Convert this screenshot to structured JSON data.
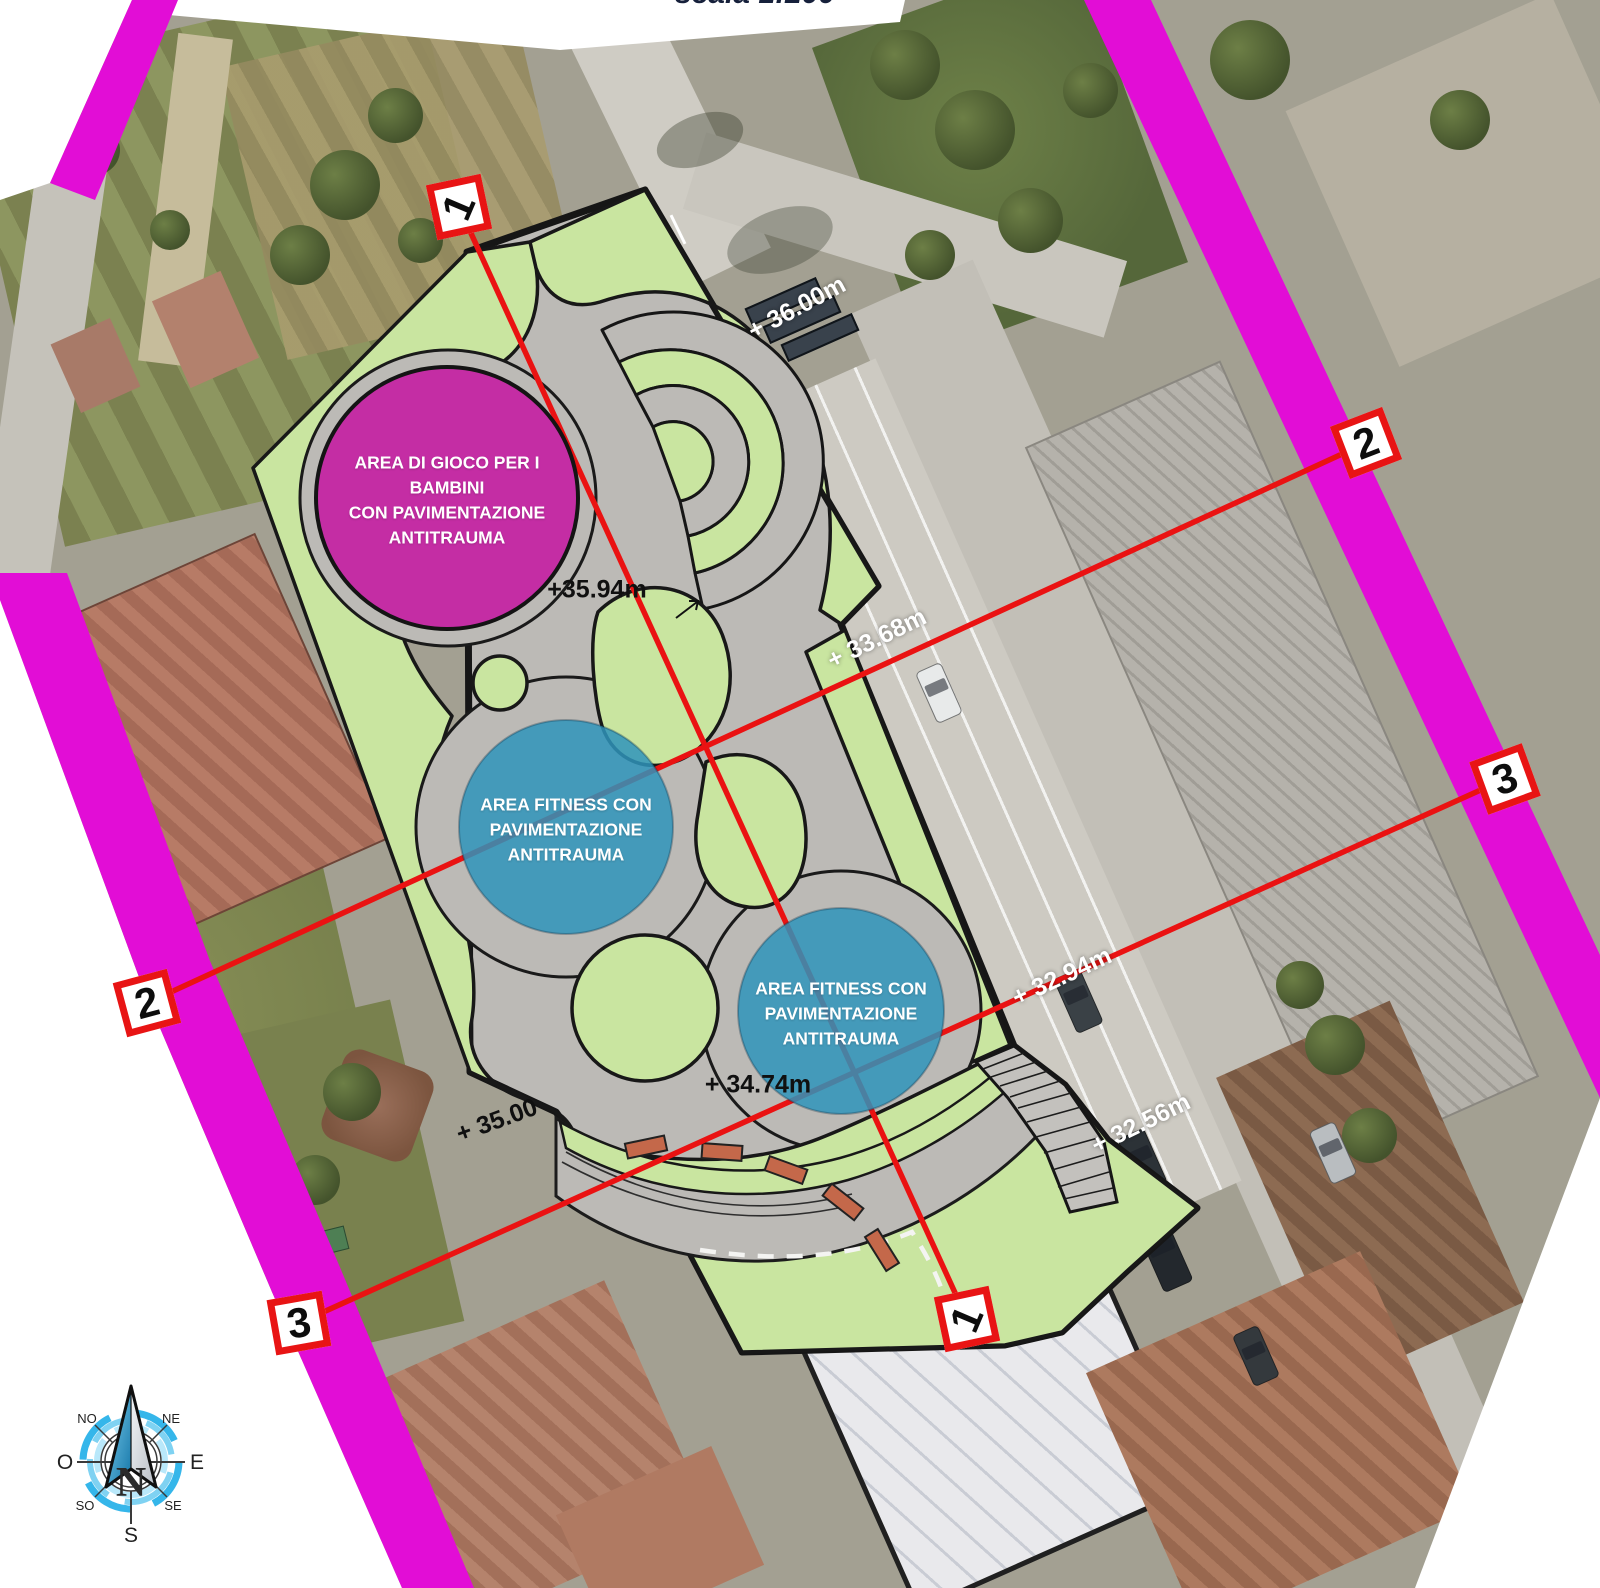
{
  "scale_label": "scala 1:200",
  "plan": {
    "play_area": {
      "lines": [
        "AREA DI GIOCO PER I BAMBINI",
        "CON PAVIMENTAZIONE",
        "ANTITRAUMA"
      ]
    },
    "fitness_area_1": {
      "lines": [
        "AREA FITNESS CON",
        "PAVIMENTAZIONE",
        "ANTITRAUMA"
      ]
    },
    "fitness_area_2": {
      "lines": [
        "AREA FITNESS CON",
        "PAVIMENTAZIONE",
        "ANTITRAUMA"
      ]
    }
  },
  "elevation_labels": [
    {
      "text": "+ 36.00m",
      "style": "white"
    },
    {
      "text": "+35.94m",
      "style": "black"
    },
    {
      "text": "+ 33.68m",
      "style": "white"
    },
    {
      "text": "+ 32.94m",
      "style": "white"
    },
    {
      "text": "+ 34.74m",
      "style": "black"
    },
    {
      "text": "+ 35.00",
      "style": "black"
    },
    {
      "text": "+ 32.56m",
      "style": "white"
    }
  ],
  "section_markers": [
    {
      "num": "1",
      "position": "top"
    },
    {
      "num": "2",
      "position": "right"
    },
    {
      "num": "3",
      "position": "right"
    },
    {
      "num": "2",
      "position": "left"
    },
    {
      "num": "3",
      "position": "left"
    },
    {
      "num": "1",
      "position": "bottom"
    }
  ],
  "compass": {
    "n": "N",
    "s": "S",
    "e": "E",
    "o": "O",
    "ne": "NE",
    "no": "NO",
    "se": "SE",
    "so": "SO"
  },
  "colors": {
    "strip_magenta": "#e20dd6",
    "play_magenta": "#c42da4",
    "fitness_teal": "#2f94bb",
    "grass_green": "#c9e5a0",
    "paving_gray": "#bcbab6",
    "section_red": "#ea1212"
  }
}
